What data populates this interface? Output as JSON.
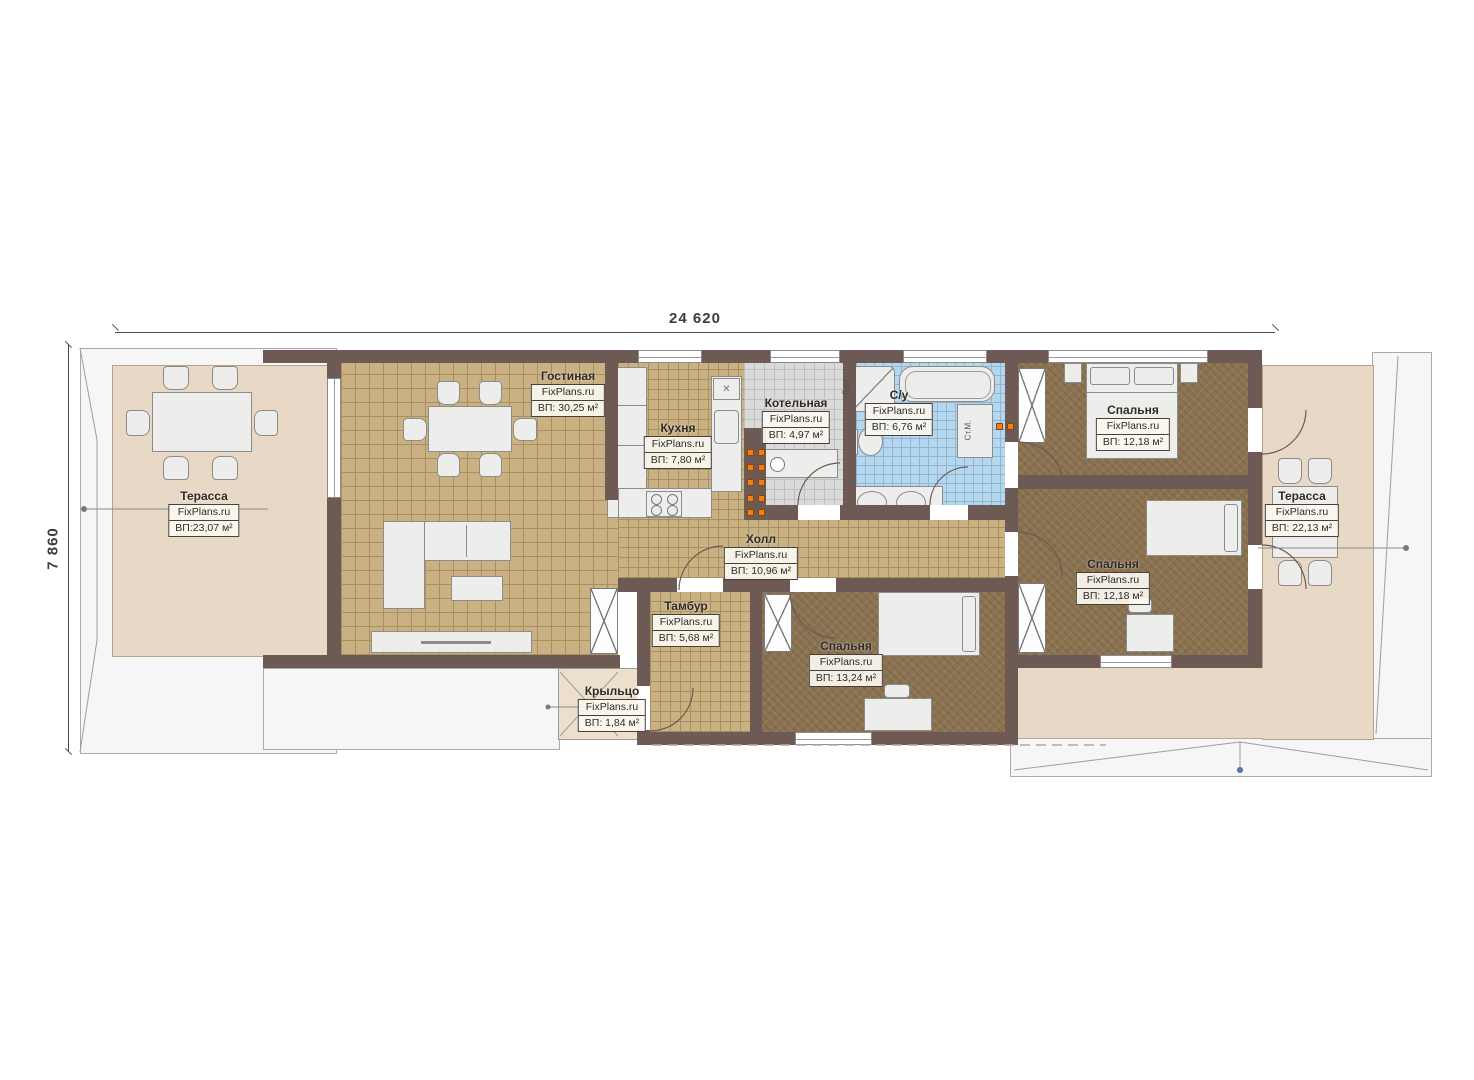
{
  "meta": {
    "brand": "FixPlans.ru",
    "drawing": "floor-plan"
  },
  "dimensions": {
    "top": "24 620",
    "left": "7 860"
  },
  "rooms": [
    {
      "id": "living",
      "name": "Гостиная",
      "brand": "FixPlans.ru",
      "area": "ВП: 30,25 м²"
    },
    {
      "id": "kitchen",
      "name": "Кухня",
      "brand": "FixPlans.ru",
      "area": "ВП: 7,80 м²"
    },
    {
      "id": "boiler",
      "name": "Котельная",
      "brand": "FixPlans.ru",
      "area": "ВП: 4,97 м²"
    },
    {
      "id": "bathroom",
      "name": "С/у",
      "brand": "FixPlans.ru",
      "area": "ВП: 6,76 м²"
    },
    {
      "id": "bedroom-top",
      "name": "Спальня",
      "brand": "FixPlans.ru",
      "area": "ВП: 12,18 м²"
    },
    {
      "id": "hall",
      "name": "Холл",
      "brand": "FixPlans.ru",
      "area": "ВП: 10,96 м²"
    },
    {
      "id": "vestibule",
      "name": "Тамбур",
      "brand": "FixPlans.ru",
      "area": "ВП: 5,68 м²"
    },
    {
      "id": "bedroom-south",
      "name": "Спальня",
      "brand": "FixPlans.ru",
      "area": "ВП: 13,24 м²"
    },
    {
      "id": "bedroom-mid",
      "name": "Спальня",
      "brand": "FixPlans.ru",
      "area": "ВП: 12,18 м²"
    },
    {
      "id": "porch",
      "name": "Крыльцо",
      "brand": "FixPlans.ru",
      "area": "ВП: 1,84 м²"
    },
    {
      "id": "terrace-left",
      "name": "Терасса",
      "brand": "FixPlans.ru",
      "area": "ВП:23,07 м²"
    },
    {
      "id": "terrace-right",
      "name": "Терасса",
      "brand": "FixPlans.ru",
      "area": "ВП: 22,13 м²"
    }
  ],
  "annotations": {
    "washer": "Ст.М.",
    "shower": "Душ"
  },
  "colors": {
    "wall": "#6e5a55",
    "floor_tile": "#c9b183",
    "floor_carpet": "#8b7351",
    "floor_bath": "#b5d7ee",
    "floor_boiler": "#dadada",
    "terrace": "#e7d9c5",
    "flue_orange": "#f07d1e",
    "roof": "#f6f6f6"
  }
}
